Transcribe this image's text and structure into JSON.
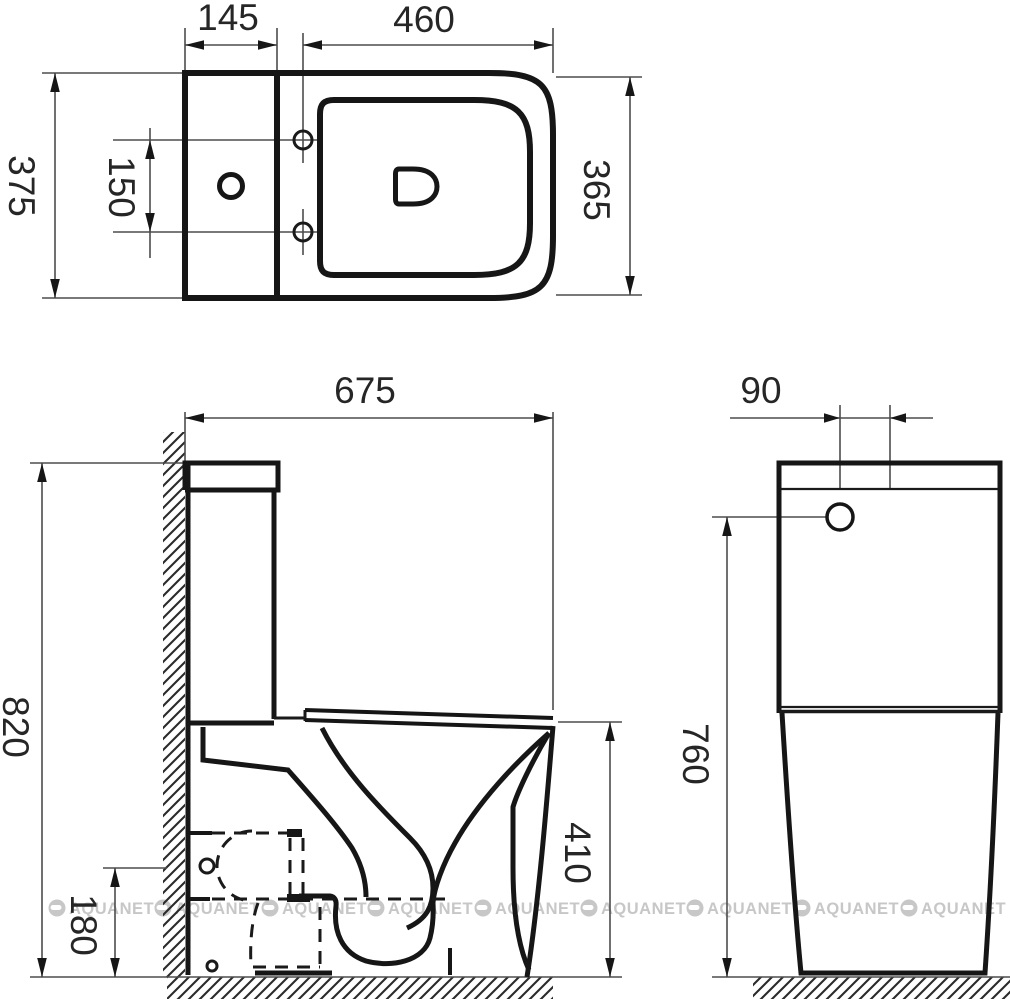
{
  "watermark": {
    "text": "AQUANET"
  },
  "top_view": {
    "dims": {
      "tank_depth_mm": "145",
      "seat_length_mm": "460",
      "overall_width_mm": "375",
      "hinge_hole_spacing_mm": "150",
      "seat_width_mm": "365"
    }
  },
  "side_view": {
    "dims": {
      "overall_depth_mm": "675",
      "overall_height_mm": "820",
      "bowl_rim_height_mm": "410",
      "outlet_height_mm": "180"
    }
  },
  "back_view": {
    "dims": {
      "inlet_offset_mm": "90",
      "tank_height_mm": "760"
    }
  }
}
